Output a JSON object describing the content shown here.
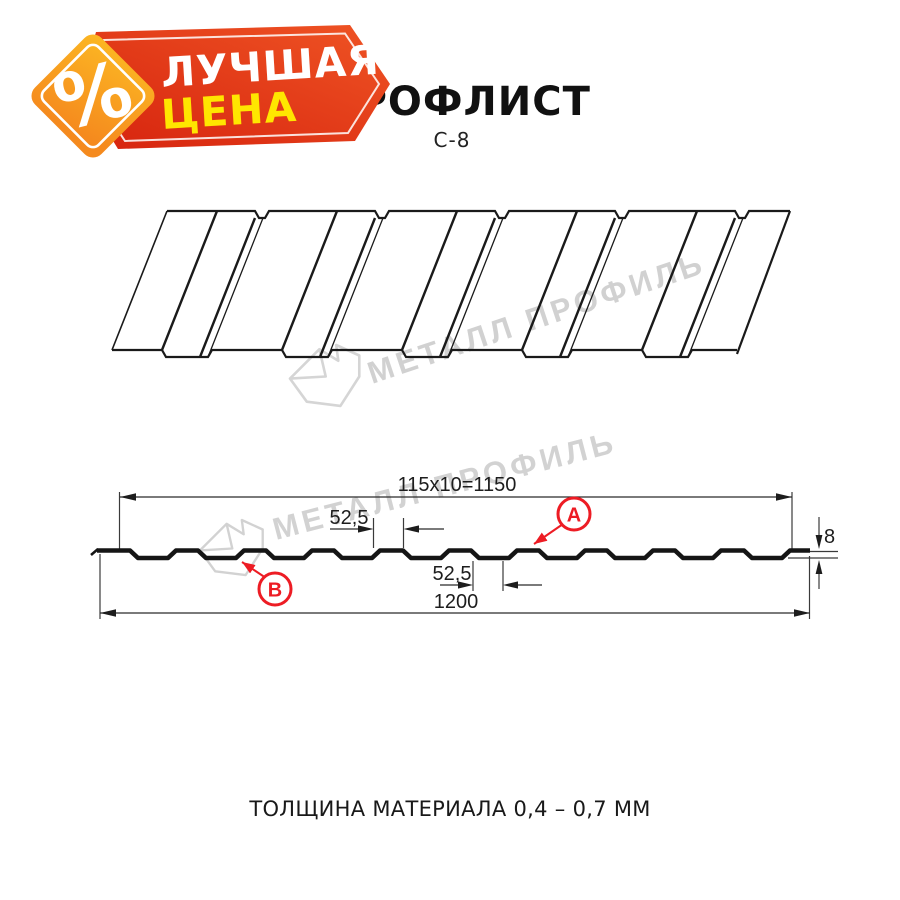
{
  "badge": {
    "percent_symbol": "%",
    "line1": "ЛУЧШАЯ",
    "line2": "ЦЕНА"
  },
  "header": {
    "title": "ПРОФЛИСТ",
    "subtitle": "С-8"
  },
  "watermark": {
    "brand": "МЕТАЛЛ ПРОФИЛЬ"
  },
  "section": {
    "dim_working_width": "115x10=1150",
    "dim_total_width": "1200",
    "dim_pitch_top": "52,5",
    "dim_pitch_bottom": "52,5",
    "dim_height": "8",
    "label_top_face": "А",
    "label_bottom_face": "В"
  },
  "footer": {
    "thickness_note": "ТОЛЩИНА МАТЕРИАЛА 0,4 – 0,7 ММ"
  },
  "colors": {
    "accent_red": "#ed1c24",
    "badge_red_dark": "#d6230e",
    "badge_red_light": "#ef5424",
    "badge_orange_light": "#fcb823",
    "badge_orange_dark": "#f58a1e",
    "badge_yellow": "#ffe600",
    "watermark_gray": "#cbcbcb",
    "line_black": "#1a1a1a"
  }
}
